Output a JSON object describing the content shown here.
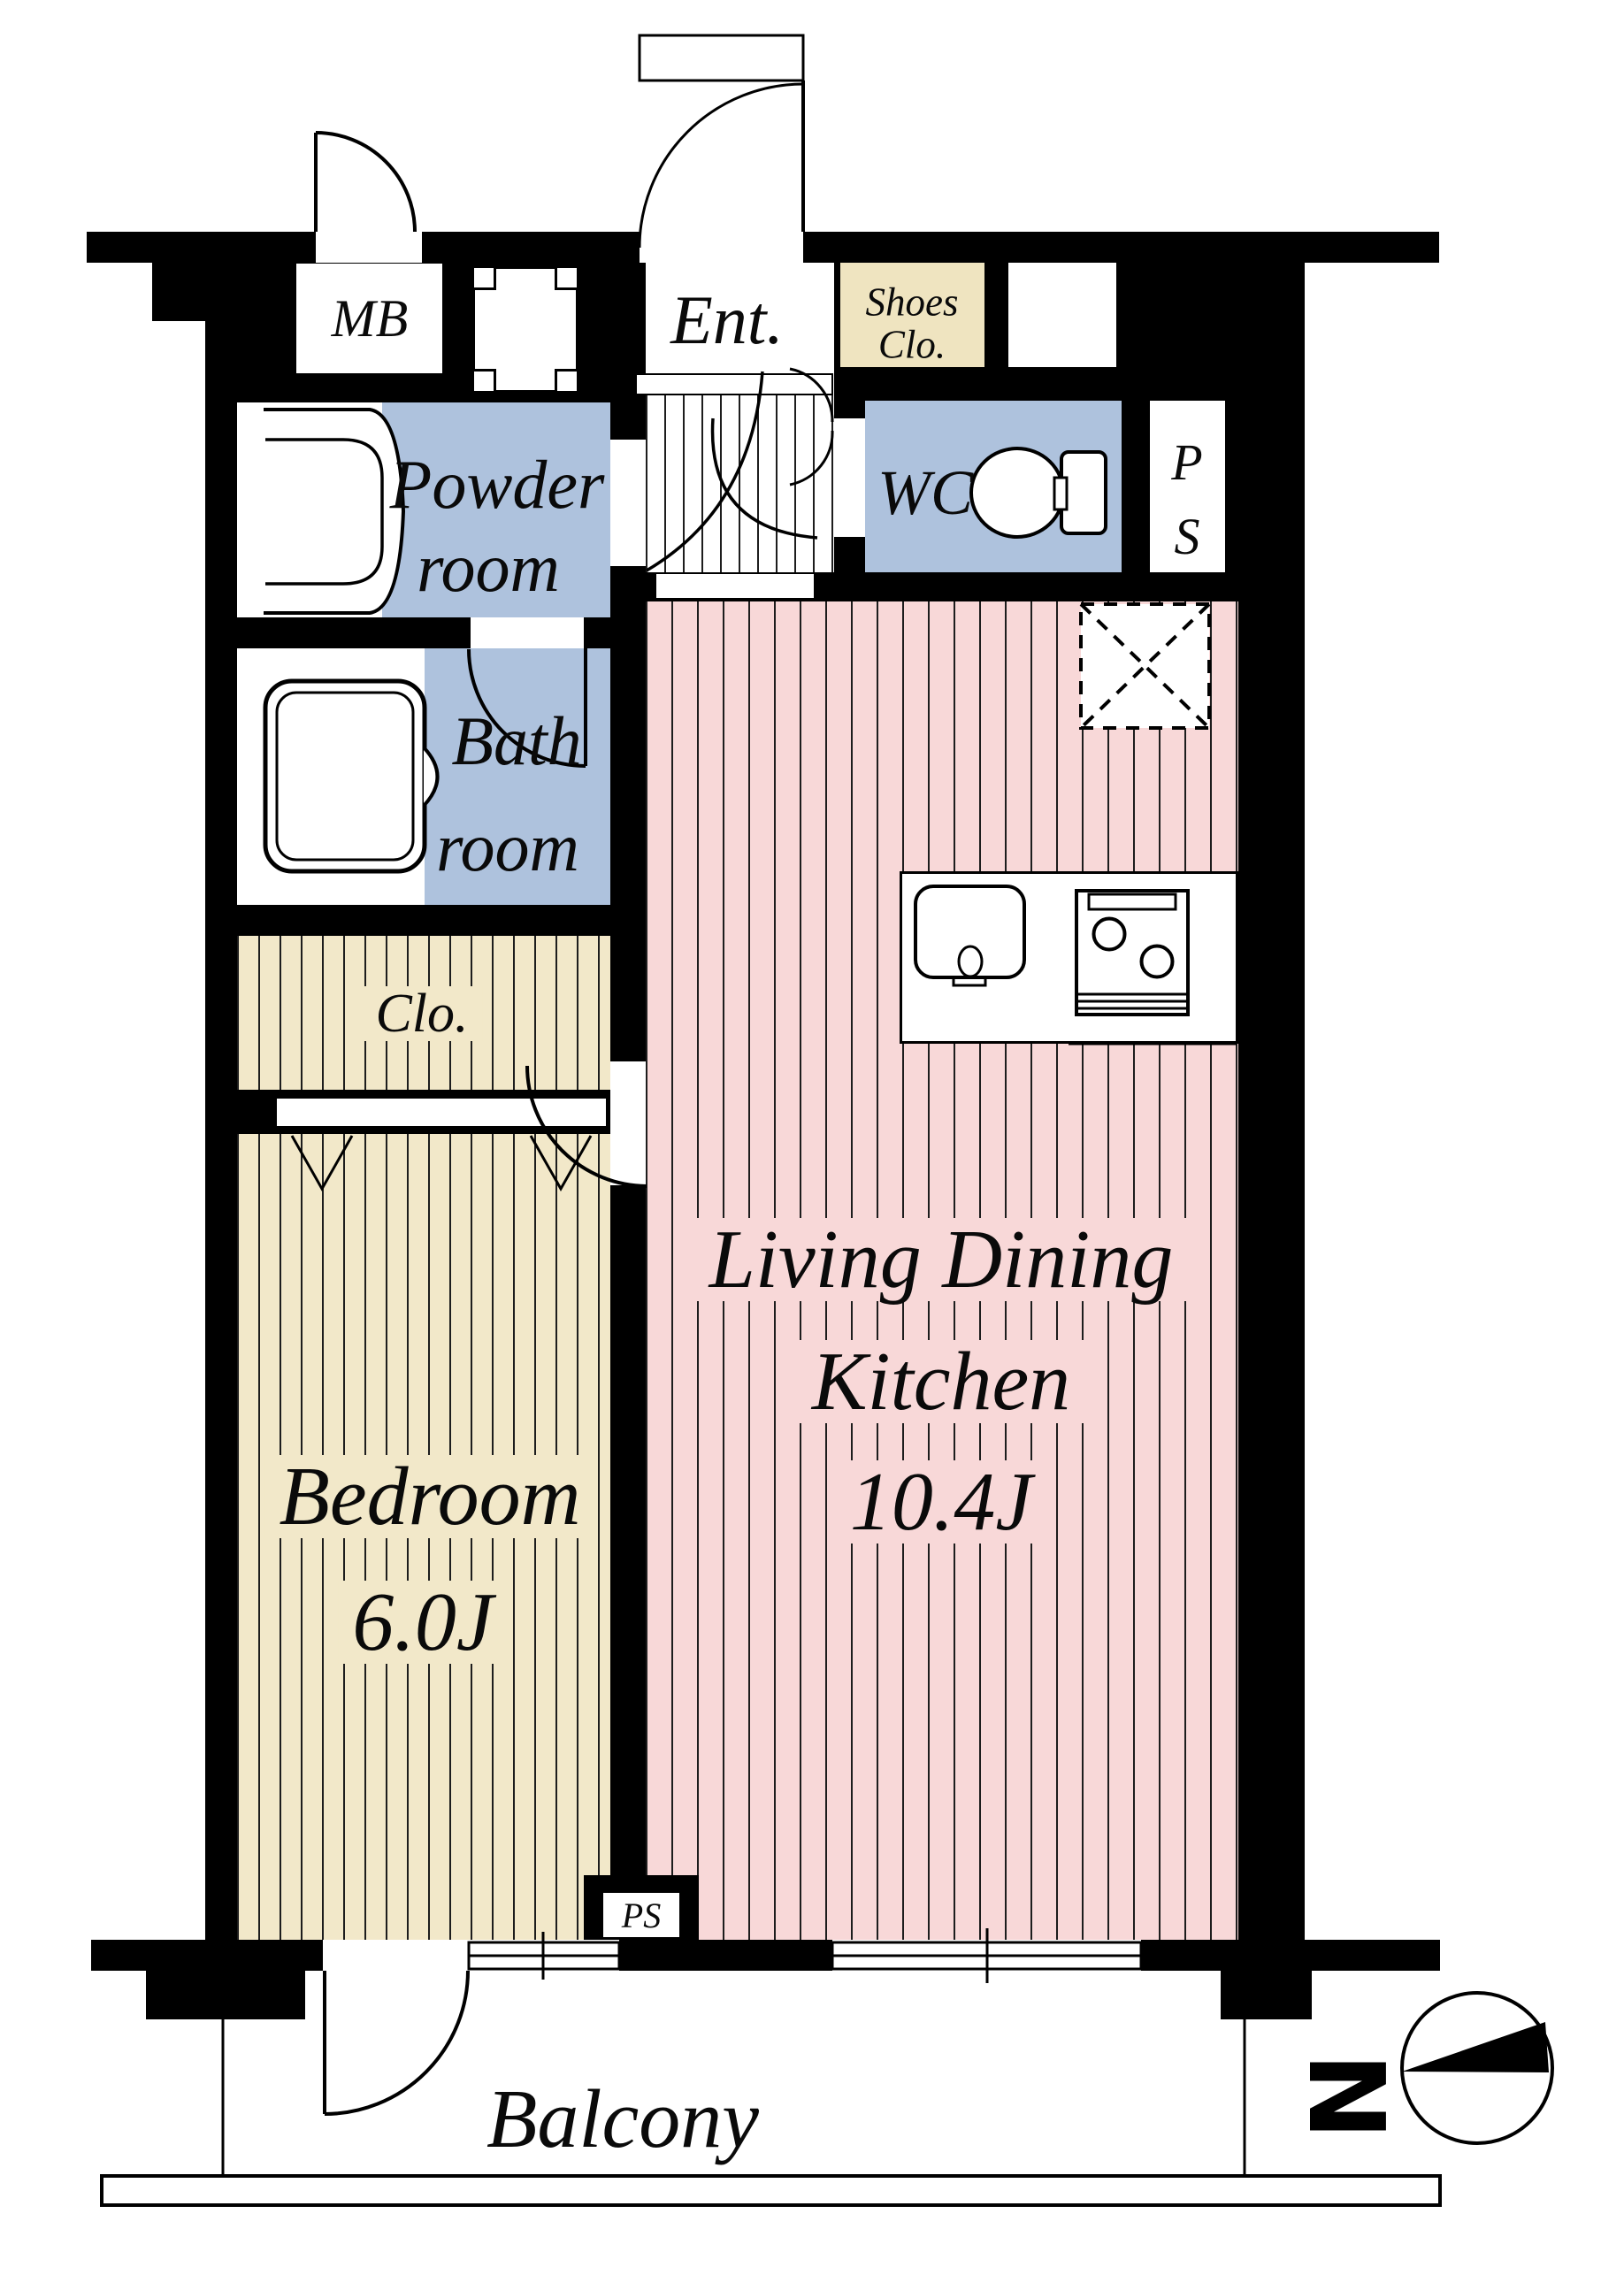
{
  "meta": {
    "type": "apartment-floor-plan",
    "layout_name": "1LDK"
  },
  "labels": {
    "mb": "MB",
    "ent": "Ent.",
    "shoes_line1": "Shoes",
    "shoes_line2": "Clo.",
    "powder_line1": "Powder",
    "powder_line2": "room",
    "wc": "WC",
    "ps_p": "P",
    "ps_s": "S",
    "bath_line1": "Bath",
    "bath_line2": "room",
    "closet": "Clo.",
    "bedroom_name": "Bedroom",
    "bedroom_size": "6.0J",
    "ldk_line1": "Living Dining",
    "ldk_line2": "Kitchen",
    "ldk_size": "10.4J",
    "balcony": "Balcony",
    "ps_small": "PS",
    "north": "N"
  },
  "colors": {
    "wall": "#000000",
    "wet_area_blue": "#aec2dd",
    "ldk_pink": "#f8d8d8",
    "bedroom_cream": "#f2e8c9",
    "shoes_beige": "#efe4c0",
    "floor_line": "#1d1d1d"
  }
}
